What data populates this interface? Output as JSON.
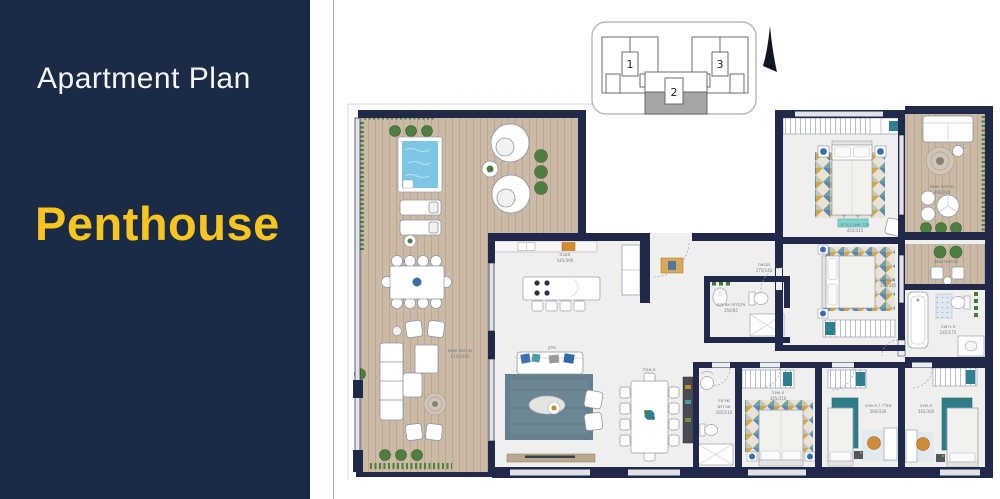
{
  "sidebar": {
    "title": "Apartment Plan",
    "subtitle": "Penthouse"
  },
  "colors": {
    "sidebar_bg": "#1b2a45",
    "accent_yellow": "#f8c51f",
    "wall_navy": "#20294a",
    "deck_wood": "#cbbaa6",
    "pool_blue": "#7ec7e4",
    "rug_blue": "#67808f",
    "rug_teal": "#2e7d8a",
    "plant_green": "#4e7f3e"
  },
  "keyplan": {
    "units": {
      "u1": "1",
      "u2": "2",
      "u3": "3"
    }
  },
  "plan": {
    "labels": {
      "terrace": {
        "name": "מרפסת שמש",
        "dims": "1150/490"
      },
      "kitchen": {
        "name": "מטבח",
        "dims": "545/390"
      },
      "living": {
        "name": "סלון"
      },
      "dining": {
        "name": "פ.אוכל"
      },
      "foyer": {
        "name": "מבואה",
        "dims": "275/145"
      },
      "shower": {
        "name": "מקלחת אורחים",
        "dims": "150/85"
      },
      "wc1": "שירותי",
      "wc2": "אורחים",
      "wc_dims": "165/110",
      "master": {
        "name": "חדר שינה הורים",
        "dims": "455/415"
      },
      "bedroom2": {
        "name": "ח.שינה",
        "dims": "335/345"
      },
      "bedroom3": {
        "name": "ח.שינה",
        "dims": "345/310"
      },
      "mamad": {
        "name": "ממ\"ד / ח.שינה",
        "dims": "260/330"
      },
      "bedroom4": {
        "name": "ח.שינה",
        "dims": "345/300"
      },
      "bath": {
        "name": "ח.רחצה",
        "dims": "245/175"
      },
      "balcony1": {
        "name": "מרפסת שמש",
        "dims": "490/285"
      },
      "balcony2": {
        "name": "מרפסת שמש",
        "dims": "285/150"
      }
    }
  }
}
